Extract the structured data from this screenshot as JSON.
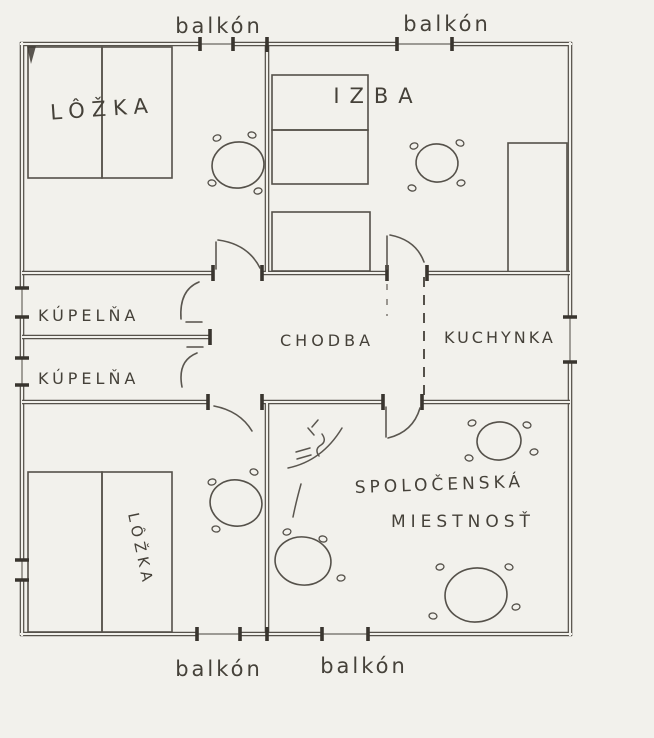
{
  "figure": {
    "type": "hand-drawn floor plan sketch",
    "language": "Slovak"
  },
  "colors": {
    "paper": "#f2f1ec",
    "ink": "#56524b",
    "ink_dark": "#39352f",
    "text": "#454139"
  },
  "labels": {
    "balkon_top_left": "balkón",
    "balkon_top_right": "balkón",
    "balkon_bottom_left": "balkón",
    "balkon_bottom_right": "balkón",
    "bedroom_top": "LÔŽKA",
    "izba": "IZBA",
    "bathroom_1": "KÚPELŇA",
    "bathroom_2": "KÚPELŇA",
    "hallway": "CHODBA",
    "kitchenette": "KUCHYNKA",
    "common_room_line1": "SPOLOČENSKÁ",
    "common_room_line2": "MIESTNOSŤ",
    "bedroom_bottom": "LÔŽKA"
  }
}
